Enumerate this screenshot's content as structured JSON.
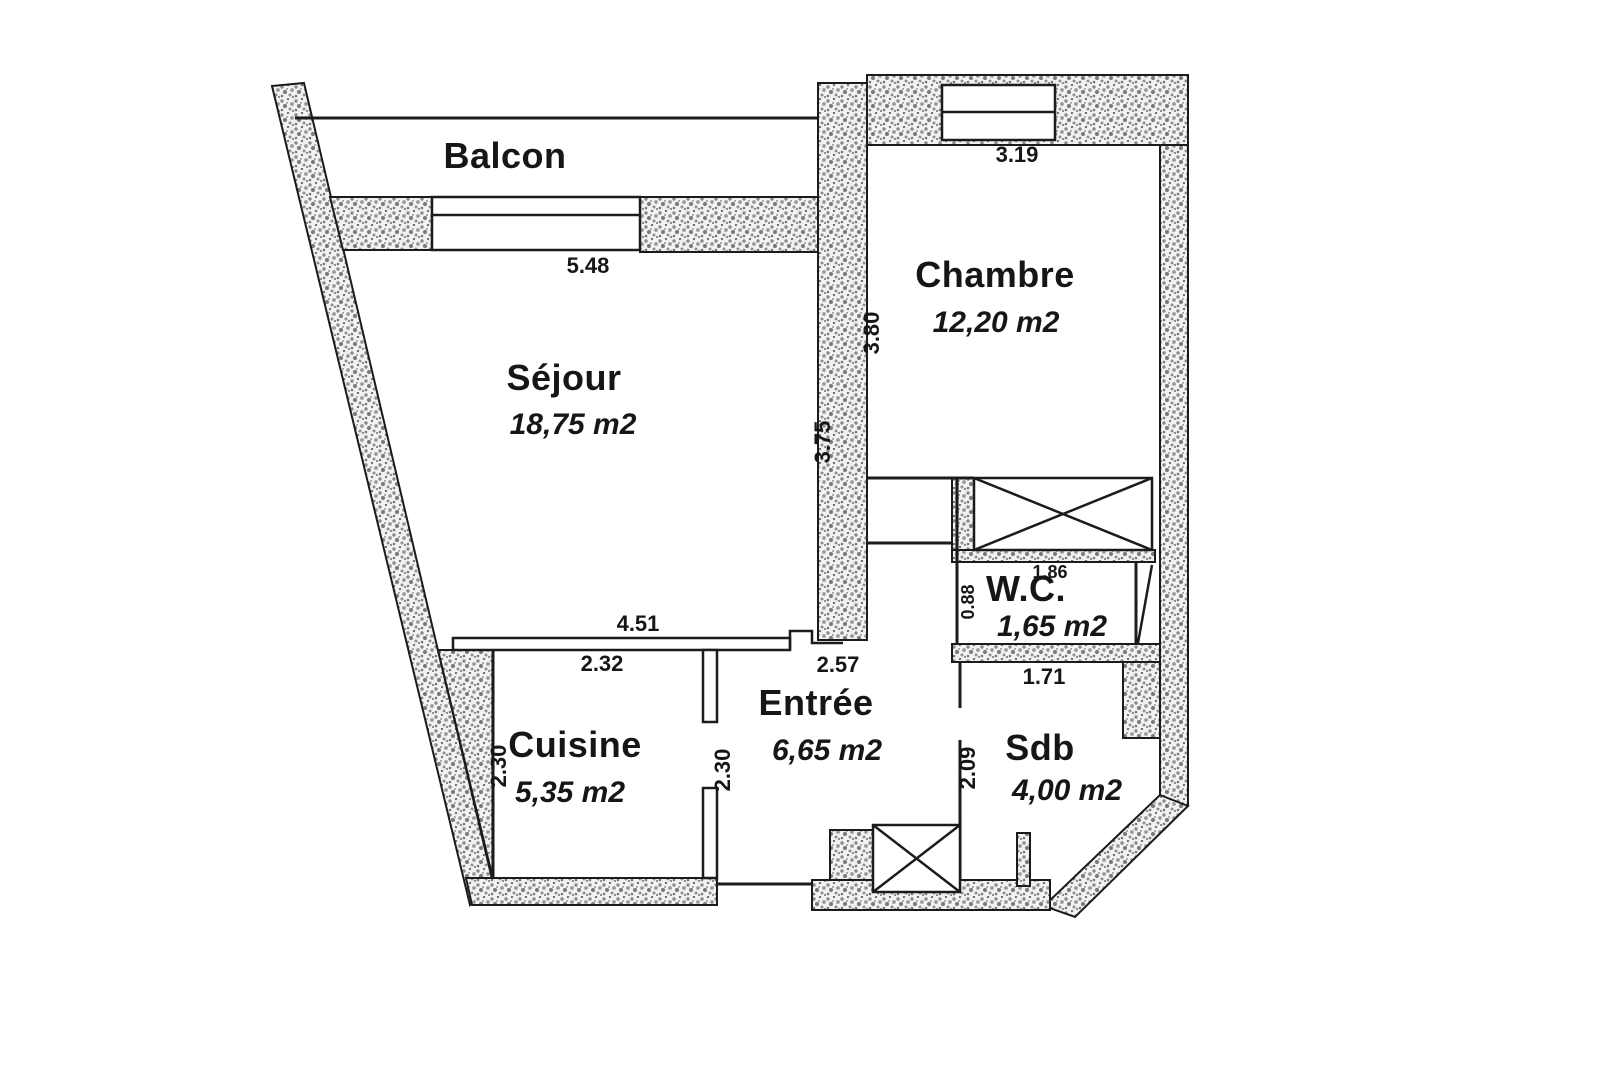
{
  "plan": {
    "balcon": {
      "label": "Balcon",
      "dim_width": "5.48"
    },
    "sejour": {
      "label": "Séjour",
      "area": "18,75 m2",
      "dim_bottom": "4.51",
      "dim_right": "3.75"
    },
    "chambre": {
      "label": "Chambre",
      "area": "12,20 m2",
      "dim_top": "3.19",
      "dim_left": "3.80"
    },
    "cuisine": {
      "label": "Cuisine",
      "area": "5,35 m2",
      "dim_top": "2.32",
      "dim_left": "2.30",
      "dim_right": "2.30"
    },
    "entree": {
      "label": "Entrée",
      "area": "6,65 m2",
      "dim_top": "2.57"
    },
    "wc": {
      "label": "W.C.",
      "area": "1,65 m2",
      "dim_top": "1.86",
      "dim_left": "0.88"
    },
    "sdb": {
      "label": "Sdb",
      "area": "4,00 m2",
      "dim_top": "1.71",
      "dim_left": "2.09"
    }
  },
  "colors": {
    "background": "#ffffff",
    "wall_outline": "#1b1b1b"
  }
}
